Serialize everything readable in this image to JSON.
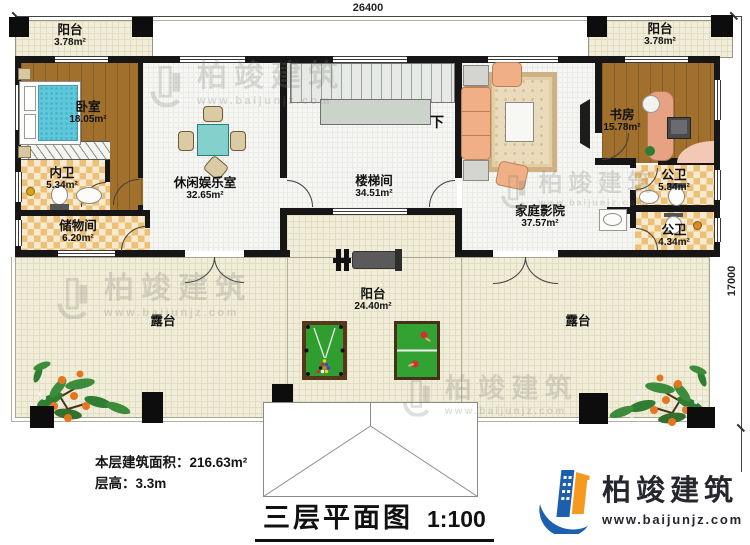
{
  "dimensions": {
    "top": "26400",
    "right": "17000"
  },
  "rooms": [
    {
      "id": "balcony-tl",
      "name": "阳台",
      "area": "3.78m²"
    },
    {
      "id": "bedroom",
      "name": "卧室",
      "area": "18.05m²"
    },
    {
      "id": "bath-private",
      "name": "内卫",
      "area": "5.34m²"
    },
    {
      "id": "storage",
      "name": "储物间",
      "area": "6.20m²"
    },
    {
      "id": "leisure",
      "name": "休闲娱乐室",
      "area": "32.65m²"
    },
    {
      "id": "stairwell",
      "name": "楼梯间",
      "area": "34.51m²"
    },
    {
      "id": "theater",
      "name": "家庭影院",
      "area": "37.57m²"
    },
    {
      "id": "study",
      "name": "书房",
      "area": "15.78m²"
    },
    {
      "id": "balcony-tr",
      "name": "阳台",
      "area": "3.78m²"
    },
    {
      "id": "bath-public-1",
      "name": "公卫",
      "area": "5.34m²"
    },
    {
      "id": "bath-public-2",
      "name": "公卫",
      "area": "4.34m²"
    },
    {
      "id": "balcony-center",
      "name": "阳台",
      "area": "24.40m²"
    },
    {
      "id": "terrace-left",
      "name": "露台",
      "area": ""
    },
    {
      "id": "terrace-right",
      "name": "露台",
      "area": ""
    }
  ],
  "stairs": {
    "down_label": "下"
  },
  "info": {
    "area_line": "本层建筑面积：216.63m²",
    "height_line": "层高：3.3m"
  },
  "title": {
    "text": "三层平面图",
    "scale": "1:100"
  },
  "brand": {
    "name": "柏竣建筑",
    "url": "www.baijunjz.com"
  },
  "watermark": {
    "name": "柏竣建筑",
    "url": "www.baijunjz.com"
  },
  "colors": {
    "wall": "#161616",
    "wood": "#a0702c",
    "tile_check": "#ecc177",
    "terrace": "#f0edd8",
    "felt_green": "#2f9e2f",
    "brand_blue": "#1b5fae",
    "brand_orange": "#f59a1f"
  }
}
